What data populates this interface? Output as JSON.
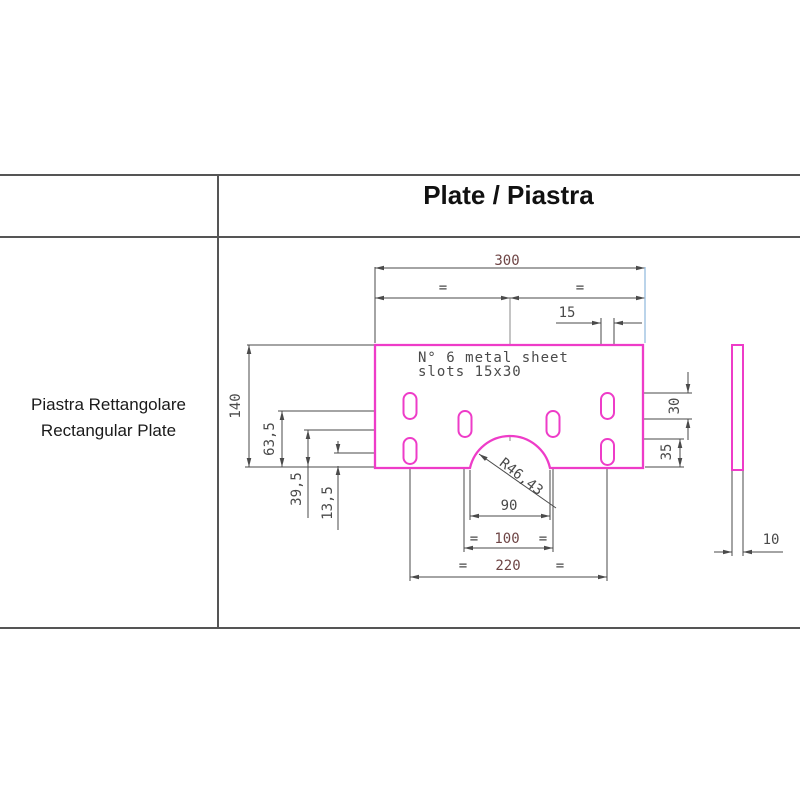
{
  "header": {
    "title": "Plate / Piastra"
  },
  "side_label": {
    "line1": "Piastra Rettangolare",
    "line2": "Rectangular Plate"
  },
  "drawing": {
    "note_line1": "N° 6 metal sheet",
    "note_line2": "slots 15x30",
    "dims": {
      "width_total": "300",
      "eq": "=",
      "slot_width": "15",
      "height_total": "140",
      "top_slot_offset": "63,5",
      "mid_slot_offset": "39,5",
      "bottom_slot_offset": "13,5",
      "slot_length": "30",
      "right_offset": "35",
      "radius": "R46,43",
      "arc_chord": "90",
      "inner_span": "100",
      "outer_span": "220",
      "thickness": "10"
    },
    "colors": {
      "outline_magenta": "#ee3cc8",
      "dimension_gray": "#4a4a4a",
      "number_maroon": "#6e4545",
      "extension_blue": "#9ec1e0",
      "centerline_gray": "#7d7d7d",
      "table_line": "#555555"
    }
  }
}
